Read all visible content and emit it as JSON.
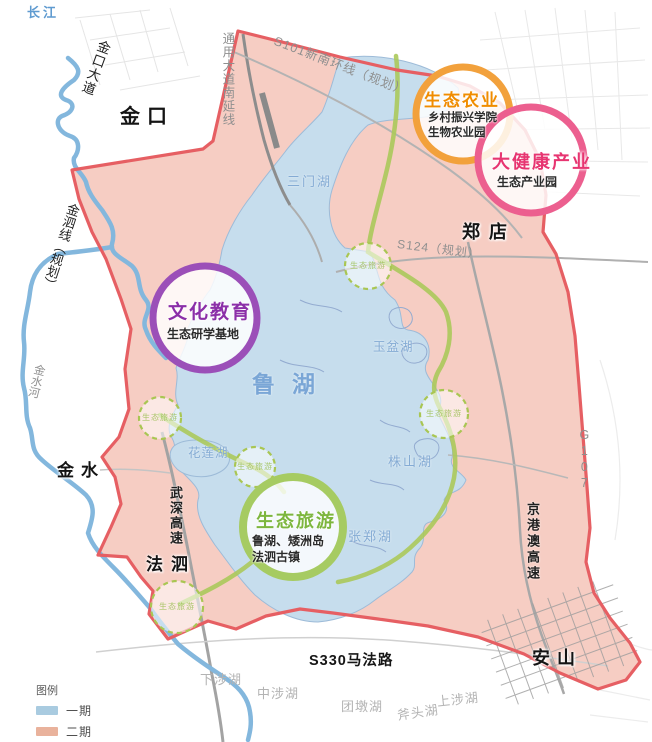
{
  "title": "鲁湖生态区规划图",
  "labels": {
    "changjiang": "长江",
    "jinkou_dadao": "金口大道",
    "tongyong_dadao": "通用大道南延线",
    "s101": "S101新南环线（规划）",
    "jinkou": "金口",
    "sanmenhu": "三门湖",
    "jinsixian": "金泗线（规划）",
    "zhengdian": "郑店",
    "s124": "S124（规划）",
    "yupenhu": "玉盆湖",
    "luhu": "鲁湖",
    "jinshuihe": "金水河",
    "jinshui": "金水",
    "g107": "G107",
    "hualianhu": "花莲湖",
    "zhushanhu": "株山湖",
    "zhangzhenghu": "张郑湖",
    "wushen_gaosu": "武深高速",
    "fasi": "法泗",
    "jinggangao_gaosu": "京港澳高速",
    "anshan": "安山",
    "s330": "S330马法路",
    "xiashehu": "下涉湖",
    "zhongshehu": "中涉湖",
    "tuandunhu": "团墩湖",
    "futouhu": "斧头湖",
    "shangshehu": "上涉湖"
  },
  "zones": {
    "agriculture": {
      "title": "生态农业",
      "line1": "乡村振兴学院",
      "line2": "生物农业园",
      "ring_color": "#f2a13c",
      "title_color": "#f08c00"
    },
    "health": {
      "title": "大健康产业",
      "line1": "生态产业园",
      "ring_color": "#ec5f8f",
      "title_color": "#e73571"
    },
    "culture": {
      "title": "文化教育",
      "line1": "生态研学基地",
      "ring_color": "#9b4fb8",
      "title_color": "#8b2fa8"
    },
    "tourism": {
      "title": "生态旅游",
      "line1": "鲁湖、矮洲岛",
      "line2": "法泗古镇",
      "ring_color": "#a6cb62",
      "title_color": "#7db63e"
    }
  },
  "eco_nodes": {
    "label": "生态旅游"
  },
  "legend": {
    "title": "图例",
    "items": [
      {
        "label": "一期",
        "color": "#a9cbe0"
      },
      {
        "label": "二期",
        "color": "#e9b29c"
      }
    ]
  },
  "palette": {
    "boundary_red": "#e65f63",
    "phase2_fill": "#f6cdc3",
    "lake_fill": "#c6dded",
    "river_blue": "#83b7dd",
    "greenway": "#abc95b"
  }
}
